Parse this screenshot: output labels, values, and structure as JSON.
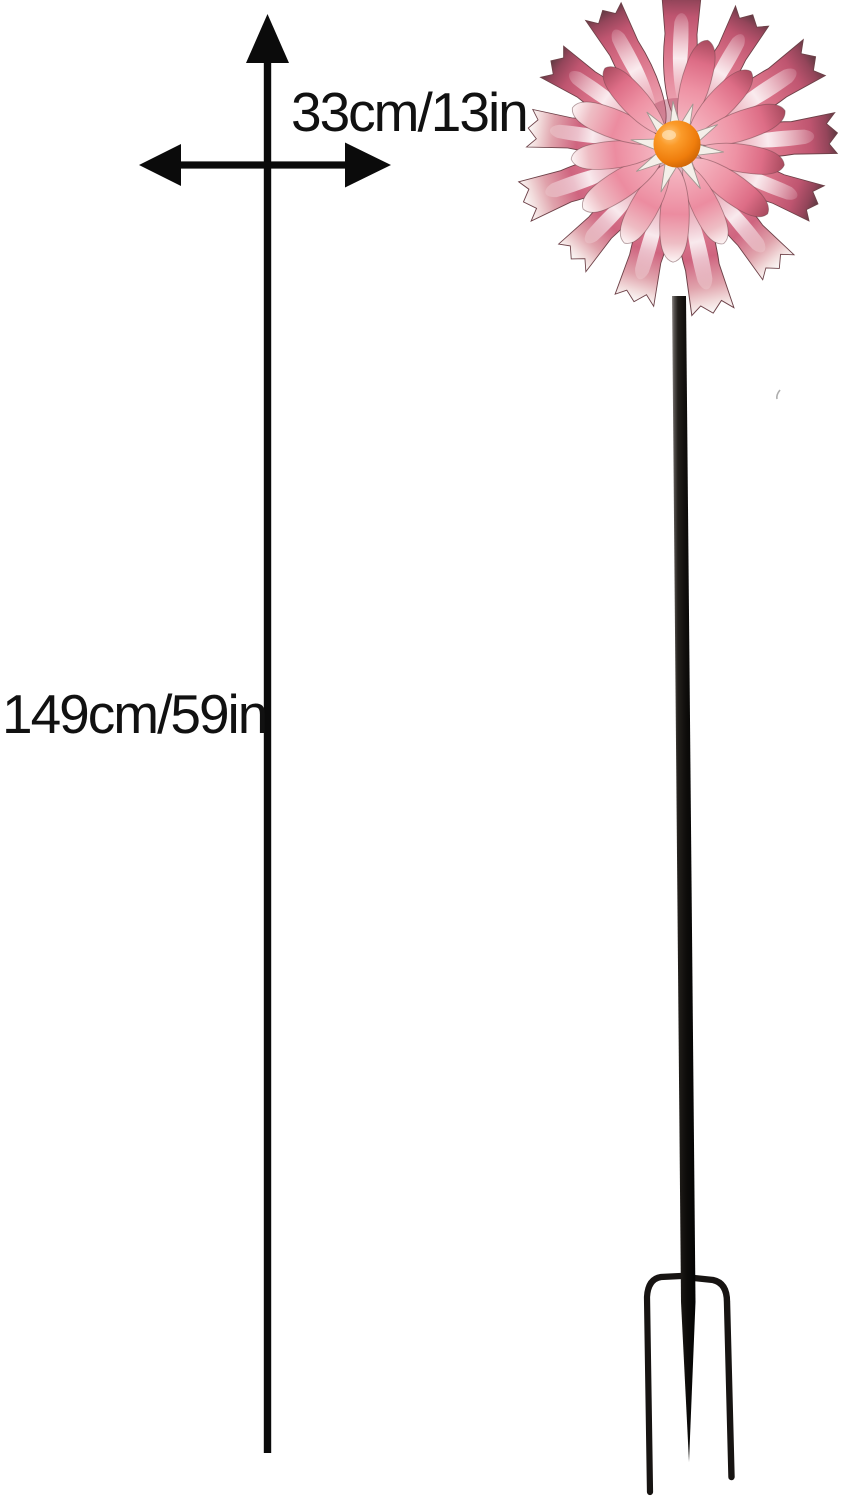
{
  "page": {
    "background": "#ffffff",
    "type": "product dimension diagram"
  },
  "dimensions": {
    "width_label": "33cm/13in",
    "height_label": "149cm/59in"
  },
  "icons": {
    "height_arrow": "vertical-line-with-up-arrowhead",
    "width_arrow": "horizontal-double-headed-arrow"
  },
  "product": {
    "description": "Pink metal pinwheel wind spinner flower on a black garden stake with three-prong ground fork",
    "colors": {
      "petal_pink": "#e2798f",
      "petal_deep_rose": "#bf5570",
      "petal_dark_tip": "#5e3a42",
      "petal_white_tip": "#fbfbfa",
      "center_orange": "#f28718",
      "stake_black": "#171412",
      "arrow_black": "#0b0b0b",
      "text_black": "#111111"
    }
  }
}
